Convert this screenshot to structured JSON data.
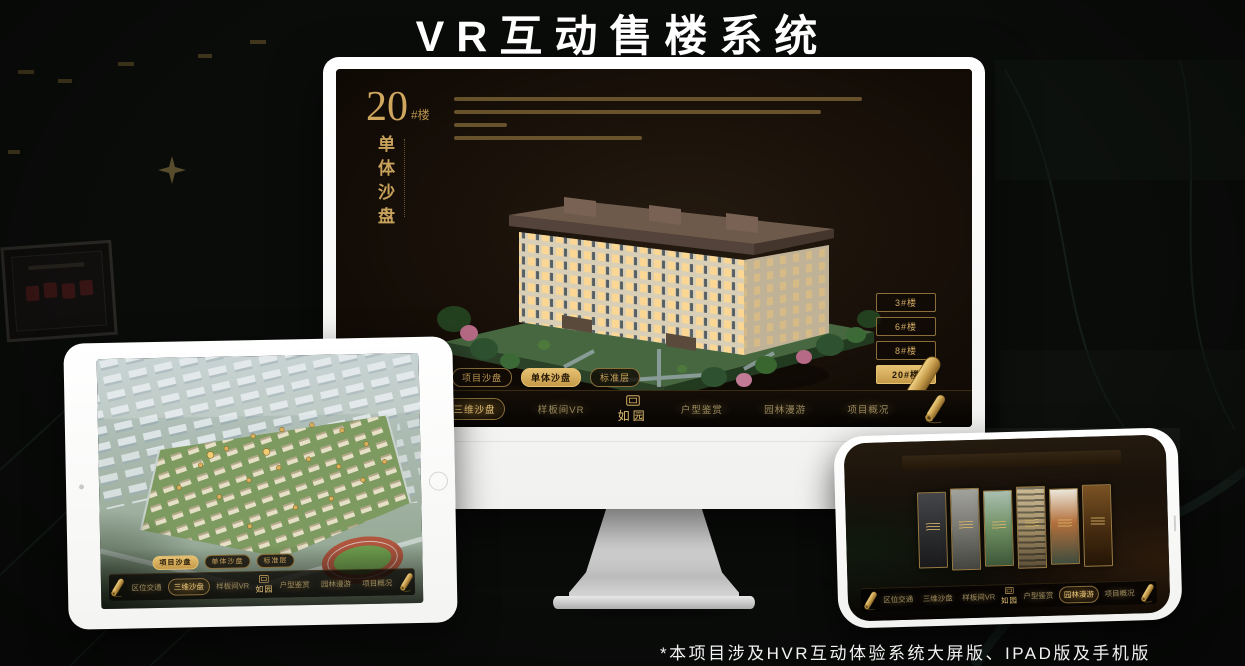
{
  "page": {
    "title": "VR互动售楼系统",
    "footnote": "*本项目涉及HVR互动体验系统大屏版、IPAD版及手机版"
  },
  "brand": {
    "logo_text": "如园"
  },
  "colors": {
    "gold": "#c9a35c",
    "screen_bg": "#170f08",
    "frame_white": "#ffffff"
  },
  "monitor": {
    "building_no": "20",
    "building_no_suffix": "#楼",
    "section_title": "单体沙盘",
    "floor_buttons": [
      {
        "label": "3#楼",
        "active": false
      },
      {
        "label": "6#楼",
        "active": false
      },
      {
        "label": "8#楼",
        "active": false
      },
      {
        "label": "20#楼",
        "active": true
      }
    ],
    "sub_tabs": [
      {
        "label": "项目沙盘",
        "active": false
      },
      {
        "label": "单体沙盘",
        "active": true
      },
      {
        "label": "标准层",
        "active": false
      }
    ],
    "nav_left": [
      {
        "label": "区位交通",
        "active": false
      },
      {
        "label": "三维沙盘",
        "active": true
      },
      {
        "label": "样板间VR",
        "active": false
      }
    ],
    "nav_right": [
      {
        "label": "户型鉴赏",
        "active": false
      },
      {
        "label": "园林漫游",
        "active": false
      },
      {
        "label": "项目概况",
        "active": false
      }
    ]
  },
  "tablet": {
    "sub_tabs": [
      {
        "label": "项目沙盘",
        "active": true
      },
      {
        "label": "单体沙盘",
        "active": false
      },
      {
        "label": "标准层",
        "active": false
      }
    ],
    "nav_left": [
      {
        "label": "区位交通",
        "active": false
      },
      {
        "label": "三维沙盘",
        "active": true
      },
      {
        "label": "样板间VR",
        "active": false
      }
    ],
    "nav_right": [
      {
        "label": "户型鉴赏",
        "active": false
      },
      {
        "label": "园林漫游",
        "active": false
      },
      {
        "label": "项目概况",
        "active": false
      }
    ]
  },
  "phone": {
    "nav_left": [
      {
        "label": "区位交通",
        "active": false
      },
      {
        "label": "三维沙盘",
        "active": false
      },
      {
        "label": "样板间VR",
        "active": false
      }
    ],
    "nav_right": [
      {
        "label": "户型鉴赏",
        "active": false
      },
      {
        "label": "园林漫游",
        "active": true
      },
      {
        "label": "项目概况",
        "active": false
      }
    ]
  }
}
